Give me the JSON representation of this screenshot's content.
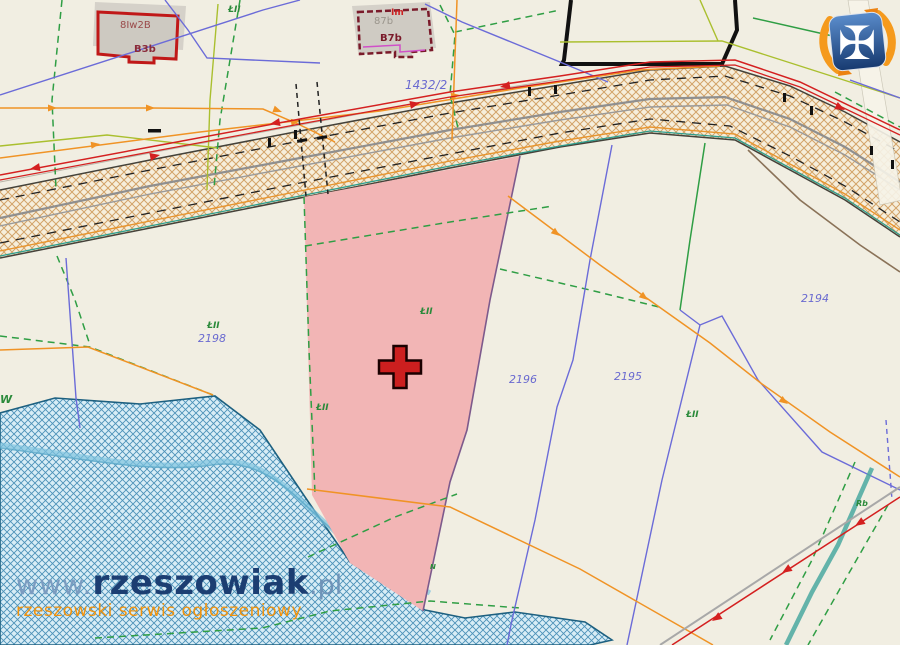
{
  "map": {
    "description": "cadastral parcel map with highlighted offer parcel",
    "colors": {
      "background": "#f1eee2",
      "highlight_parcel": "#f2b5b5",
      "marker_red": "#cc1f1f",
      "road_hatch": "#d3a369",
      "water_fill": "#d8edf6",
      "water_hatch": "#4d92b8",
      "boundary_green": "#2f9e44",
      "utility_red": "#d42020",
      "utility_orange": "#f09325",
      "line_blue": "#6b6bd8",
      "line_olive": "#aabf2e",
      "label_violet": "#6a6ad0",
      "label_green": "#2a8a3a",
      "building_outline_red": "#c01818"
    },
    "parcels": {
      "labels": [
        {
          "text": "1432/2"
        },
        {
          "text": "2198"
        },
        {
          "text": "2196"
        },
        {
          "text": "2195"
        },
        {
          "text": "2194"
        }
      ]
    },
    "land_use_marks": [
      {
        "text": "ŁII"
      },
      {
        "text": "ŁII"
      },
      {
        "text": "ŁII"
      },
      {
        "text": "ŁII"
      },
      {
        "text": "ŁII"
      },
      {
        "text": "W"
      },
      {
        "text": "N"
      },
      {
        "text": "Rb"
      }
    ],
    "buildings": {
      "b1_label_top": "8Iw2B",
      "b1_label_bottom": "B3b",
      "b2_mark": "Im",
      "b2_label_top": "87b",
      "b2_label_bottom": "B7b"
    }
  },
  "watermark": {
    "www": "www.",
    "main": "rzeszowiak",
    "pl": ".pl",
    "tagline": "rzeszowski serwis ogłoszeniowy"
  },
  "logo": {
    "name": "rzeszowiak-shield-logo"
  }
}
